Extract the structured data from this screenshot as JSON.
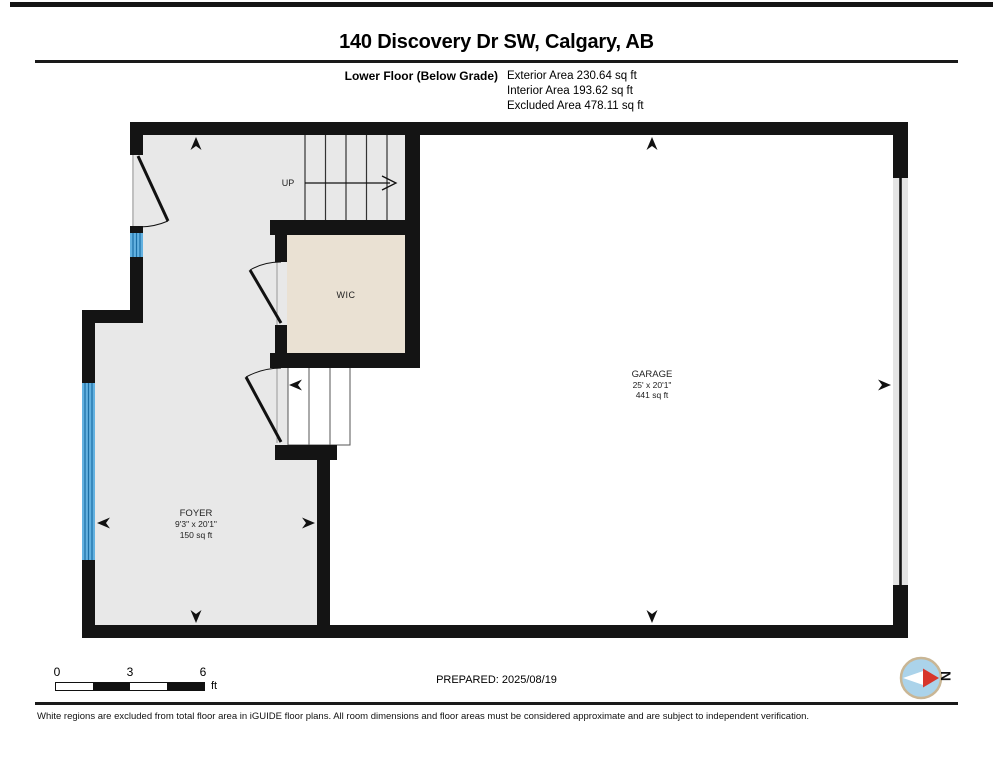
{
  "header": {
    "title": "140 Discovery Dr SW, Calgary, AB",
    "floor_label": "Lower Floor (Below Grade)",
    "area_lines": [
      "Exterior Area 230.64 sq ft",
      "Interior Area 193.62 sq ft",
      "Excluded Area 478.11 sq ft"
    ]
  },
  "floorplan": {
    "rooms": [
      {
        "name": "FOYER",
        "dimensions": "9'3\" x 20'1\"",
        "area": "150 sq ft"
      },
      {
        "name": "WIC"
      },
      {
        "name": "GARAGE",
        "dimensions": "25' x 20'1\"",
        "area": "441 sq ft"
      }
    ],
    "stairs_label": "UP",
    "colors": {
      "wall": "#141414",
      "interior_floor": "#e8e8e8",
      "excluded_floor": "#ffffff",
      "wic_floor": "#eae1d3",
      "window_blue": "#63b1e0",
      "garage_door_gray": "#e4e4e4",
      "compass_blue": "#abd3ea",
      "compass_red": "#d7352b",
      "compass_ring_tan": "#c9b695"
    }
  },
  "footer": {
    "scale_bar": {
      "ticks": [
        "0",
        "3",
        "6"
      ],
      "unit": "ft"
    },
    "prepared_label": "PREPARED: 2025/08/19",
    "compass_label": "N",
    "disclaimer": "White regions are excluded from total floor area in iGUIDE floor plans. All room dimensions and floor areas must be considered approximate and are subject to independent verification."
  }
}
